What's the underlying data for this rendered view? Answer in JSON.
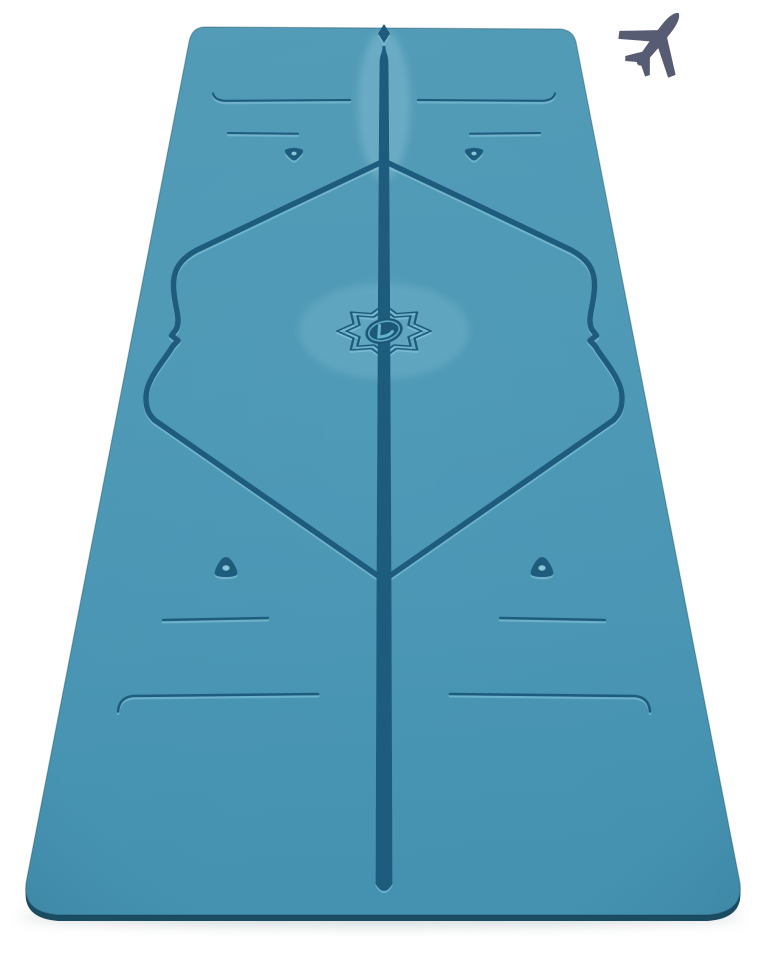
{
  "theme": {
    "bg": "#ffffff",
    "mat-top": "#549db9",
    "mat-mid": "#4f9ab7",
    "mat-bottom": "#4593b2",
    "mat-line": "#1e5c7e",
    "mat-edge": "#1b4c61",
    "etch-light": "#9ed8e8",
    "logo-oval": "#1d5878",
    "logo-accent": "#64b2cd",
    "plane": "#575c73",
    "shadow": "#b9c2c6"
  },
  "scene": {
    "background_color": "#ffffff",
    "airplane": {
      "label": "airplane icon",
      "color": "#575c73"
    },
    "mat": {
      "label": "blue alignment yoga mat, portrait product view",
      "base_color": "#4f9ab7",
      "line_color": "#1e5c7e",
      "edge_color": "#1b4c61",
      "logo_label": "lotus flower logo with letter L",
      "logo_oval_color": "#1d5878",
      "logo_accent_color": "#64b2cd",
      "markings": [
        "center line with diamond arrow tip",
        "45-degree alignment frame with wavy midpoint curls",
        "top end line pair with upward hooks",
        "top inner short line pair",
        "top marker dot pair pointing down",
        "mid marker dot pair pointing up",
        "bottom inner short line pair",
        "bottom end line pair with downward hooks"
      ]
    }
  }
}
